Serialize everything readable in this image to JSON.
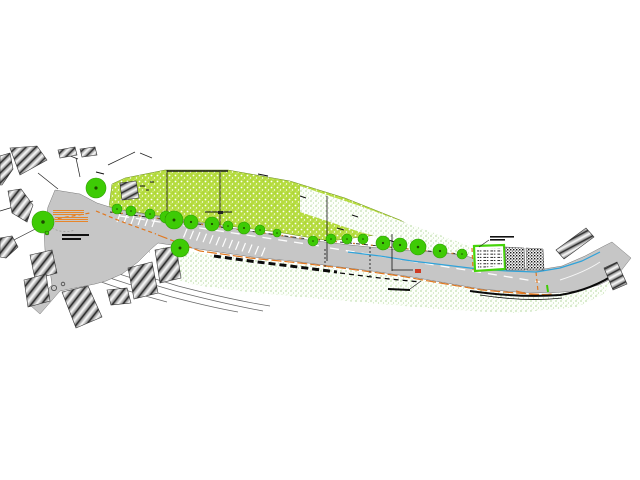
{
  "colors": {
    "road_gray": "#c6c6c6",
    "hill_base": "#b5dc3e",
    "tree_green": "#3ecb05",
    "tree_edge": "#2f9e04",
    "tree_dot": "#1d4a00",
    "stair_orange": "#e8862a",
    "route_orange": "#e07820",
    "curb_brown": "#c8782a",
    "water_blue": "#2fa3da",
    "box_green": "#46d40a",
    "red_marker": "#d03a22",
    "meadow_dot": "#8fc473"
  },
  "geometry": {
    "road": "M55,190 L80,194 L97,203 L116,209 L150,215 L200,223 L250,231 L300,239 L350,245 L400,250 L435,252 L462,255 L492,263 L515,268 L538,270 L562,266 L585,256 L604,246 L612,242 L631,258 L617,276 L599,285 L576,291 L549,293 L516,292 L481,289 L446,283 L412,277 L372,271 L332,266 L292,261 L252,257 L212,251 L178,246 L158,243 L150,250 L138,262 L122,274 L106,281 L95,284 L60,291 L40,314 L31,306 L52,285 L50,270 L45,250 L44,230 L48,207 Z",
    "hill": "M108,215 L112,184 L125,178 L165,170 L228,170 L290,181 L345,198 L400,220 L433,238 L436,246 L392,233 L330,241 L277,232 L228,226 L178,219 L130,211 Z",
    "slope_band": "M300,186 L360,206 L420,228 L470,246 L470,258 L420,248 L360,232 L300,212 Z",
    "meadow": "M160,247 L200,253 L250,259 L300,264 L350,270 L400,277 L445,284 L480,290 L515,293 L548,294 L575,292 L598,287 L612,280 L604,294 L577,307 L515,313 L452,310 L370,303 L300,297 L240,291 L195,285 L178,280 L170,268 L163,255 Z",
    "blue_line": "M348,252 L380,256 L412,261 L445,265 L478,269 L508,271 L536,272 L560,268 L582,261 L600,252",
    "orange_curb": "M158,235 L200,251 L250,258 L300,263 L350,269 L400,276 L446,284 L482,290 L516,293 L550,295",
    "orange_route": "M44,221 L90,213 M96,211 L120,221 L156,234",
    "orange_row": "M112,212 L300,238 L468,255",
    "orange_vert1": "M536,272 L538,291",
    "orange_vert2": "M472,248 L473,270",
    "orange_end_arc": "M516,291 Q536,297 552,294",
    "row_dark": "M110,212 L300,238 L468,255",
    "wall_heavy": "M214,256 L250,261 L290,266 L337,272",
    "wall_thin": "M340,273 L380,278 L420,282",
    "outer_heavy": "M470,291 Q520,298 560,295 Q592,290 618,272",
    "outer_thin": "M480,295 Q525,302 562,298",
    "scale_bar": "M388,289 L410,290",
    "scale_leader": "M410,289 L421,281",
    "center_dash1": "M120,216 L320,246",
    "center_dash2": "M330,248 L540,282",
    "white_curve_end": "M560,280 Q585,272 600,262",
    "hill_top": "M167,171 L228,171",
    "plaza_edge_dash": "M108,246 L150,252",
    "stairs_arc": "M52,228 Q63,234 75,230",
    "bus_leader": "M489,240 L479,247",
    "green_dash": "M547,285 L548,292",
    "green_box": "474,246 504,245 505,269 475,271",
    "green_box_inner": "M477,249 L501,248 L502,266 L478,268 Z",
    "speckle_panel_1": "505,247 524,248 525,270 506,270",
    "speckle_panel_2": "526,248 543,249 544,270 527,270",
    "fan": [
      "M73,251 Q125,270 178,286 Q232,300 270,306",
      "M70,257 Q122,276 175,291 Q225,304 263,311",
      "M68,263 Q118,282 172,297 Q210,307 238,312",
      "M66,269 Q114,288 167,302"
    ],
    "dashed_vert": [
      "M325,249 L325,267",
      "M370,247 L370,276"
    ]
  },
  "trees": [
    {
      "x": 43,
      "y": 222,
      "r": 11
    },
    {
      "x": 96,
      "y": 188,
      "r": 10
    },
    {
      "x": 117,
      "y": 209,
      "r": 5
    },
    {
      "x": 131,
      "y": 211,
      "r": 5
    },
    {
      "x": 150,
      "y": 214,
      "r": 5
    },
    {
      "x": 166,
      "y": 217,
      "r": 6
    },
    {
      "x": 174,
      "y": 220,
      "r": 9
    },
    {
      "x": 191,
      "y": 222,
      "r": 7
    },
    {
      "x": 212,
      "y": 224,
      "r": 7
    },
    {
      "x": 228,
      "y": 226,
      "r": 5
    },
    {
      "x": 244,
      "y": 228,
      "r": 6
    },
    {
      "x": 260,
      "y": 230,
      "r": 5
    },
    {
      "x": 277,
      "y": 233,
      "r": 4
    },
    {
      "x": 180,
      "y": 248,
      "r": 9
    },
    {
      "x": 313,
      "y": 241,
      "r": 5
    },
    {
      "x": 331,
      "y": 239,
      "r": 5
    },
    {
      "x": 347,
      "y": 239,
      "r": 5
    },
    {
      "x": 363,
      "y": 239,
      "r": 5
    },
    {
      "x": 383,
      "y": 243,
      "r": 7
    },
    {
      "x": 400,
      "y": 245,
      "r": 7
    },
    {
      "x": 418,
      "y": 247,
      "r": 8
    },
    {
      "x": 440,
      "y": 251,
      "r": 7
    },
    {
      "x": 462,
      "y": 254,
      "r": 5
    }
  ],
  "buildings": [
    {
      "points": "10,148 37,146 47,160 20,175",
      "hatch": "hatchB"
    },
    {
      "points": "0,156 10,153 13,169 2,185 0,185",
      "hatch": "hatchB"
    },
    {
      "points": "8,191 21,189 33,205 27,222 12,213",
      "hatch": "hatchA"
    },
    {
      "points": "0,238 12,236 18,247 6,258 0,257",
      "hatch": "hatchA"
    },
    {
      "points": "30,255 52,250 57,273 35,279",
      "hatch": "hatchA"
    },
    {
      "points": "24,280 46,274 50,301 28,307",
      "hatch": "hatchA"
    },
    {
      "points": "62,292 88,286 102,317 76,328",
      "hatch": "hatchA"
    },
    {
      "points": "128,268 152,262 158,293 134,299",
      "hatch": "hatchA"
    },
    {
      "points": "155,250 176,246 181,278 160,283",
      "hatch": "hatchA"
    },
    {
      "points": "107,290 127,288 131,303 111,305",
      "hatch": "hatchA"
    },
    {
      "points": "120,183 136,181 139,198 122,200",
      "hatch": "hatchC"
    },
    {
      "points": "556,250 586,228 594,237 564,259",
      "hatch": "hatchC"
    },
    {
      "points": "604,268 617,262 627,284 613,290",
      "hatch": "hatchC"
    },
    {
      "points": "58,150 75,147 77,155 60,158",
      "hatch": "hatchB"
    },
    {
      "points": "80,149 95,147 97,155 82,157",
      "hatch": "hatchB"
    }
  ],
  "stairs": {
    "lines": [
      [
        53,
        210.5,
        84,
        210.5
      ],
      [
        53,
        212.5,
        84,
        212.5
      ],
      [
        53,
        214.5,
        84,
        214.5
      ],
      [
        55,
        217.5,
        88,
        217.5
      ],
      [
        55,
        219.5,
        88,
        219.5
      ],
      [
        55,
        221.5,
        88,
        221.5
      ]
    ]
  },
  "markings": {
    "stair_ticks": [
      [
        187,
        229,
        183.5,
        237.5
      ],
      [
        193.5,
        230.6,
        190,
        239.1
      ],
      [
        200,
        232.1,
        196.5,
        240.6
      ],
      [
        206.5,
        233.7,
        203,
        242.2
      ],
      [
        213,
        235.2,
        209.5,
        243.7
      ],
      [
        219.5,
        236.8,
        216,
        245.3
      ],
      [
        226,
        238.3,
        222.5,
        246.8
      ],
      [
        232.5,
        239.9,
        229,
        248.4
      ],
      [
        239,
        241.4,
        235.5,
        249.9
      ],
      [
        245.5,
        243,
        242,
        251.5
      ],
      [
        252,
        244.5,
        248.5,
        253
      ],
      [
        258.5,
        246.1,
        255,
        254.6
      ],
      [
        265,
        247.6,
        261.5,
        256.1
      ]
    ],
    "parking_ticks": [
      [
        120,
        214,
        117,
        222
      ],
      [
        127,
        215,
        124,
        223
      ],
      [
        134,
        216,
        131,
        224
      ],
      [
        141,
        217,
        138,
        225
      ],
      [
        148,
        218,
        145,
        226
      ],
      [
        155,
        219,
        152,
        227
      ]
    ]
  },
  "poles": [
    [
      167,
      170,
      167,
      212
    ],
    [
      220,
      172,
      220,
      226
    ],
    [
      327,
      196,
      327,
      261
    ],
    [
      392,
      234,
      392,
      271
    ],
    [
      392,
      270,
      413,
      270
    ]
  ],
  "thin_lines": [
    [
      33,
      201,
      0,
      211
    ],
    [
      47,
      223,
      8,
      243
    ],
    [
      58,
      189,
      38,
      173
    ],
    [
      80,
      177,
      76,
      158
    ],
    [
      60,
      152,
      78,
      159
    ],
    [
      140,
      153,
      152,
      158
    ],
    [
      108,
      165,
      135,
      152
    ]
  ],
  "hill_marks": [
    [
      140,
      186,
      145,
      186
    ],
    [
      150,
      182,
      154,
      182
    ],
    [
      146,
      190,
      149,
      190
    ],
    [
      205,
      212,
      232,
      212
    ],
    [
      96,
      172,
      104,
      174
    ],
    [
      258,
      174,
      268,
      176
    ],
    [
      337,
      228,
      344,
      230
    ],
    [
      388,
      240,
      395,
      242
    ],
    [
      352,
      215,
      358,
      217
    ],
    [
      300,
      196,
      306,
      198
    ]
  ],
  "hill_rect": [
    218,
    211,
    5,
    3
  ],
  "labels": {
    "plaza_bars": [
      [
        62,
        234,
        27,
        2
      ],
      [
        62,
        238,
        19,
        2
      ]
    ],
    "bus_bars": [
      [
        490,
        236,
        24,
        1.6
      ],
      [
        490,
        239,
        15,
        1.6
      ]
    ]
  },
  "markers": {
    "red": {
      "x": 415,
      "y": 269,
      "w": 6,
      "h": 4
    },
    "green_dot": {
      "x": 47,
      "y": 233,
      "r": 2
    },
    "manholes": [
      [
        54,
        288,
        2.6
      ],
      [
        63,
        284,
        1.8
      ]
    ]
  }
}
